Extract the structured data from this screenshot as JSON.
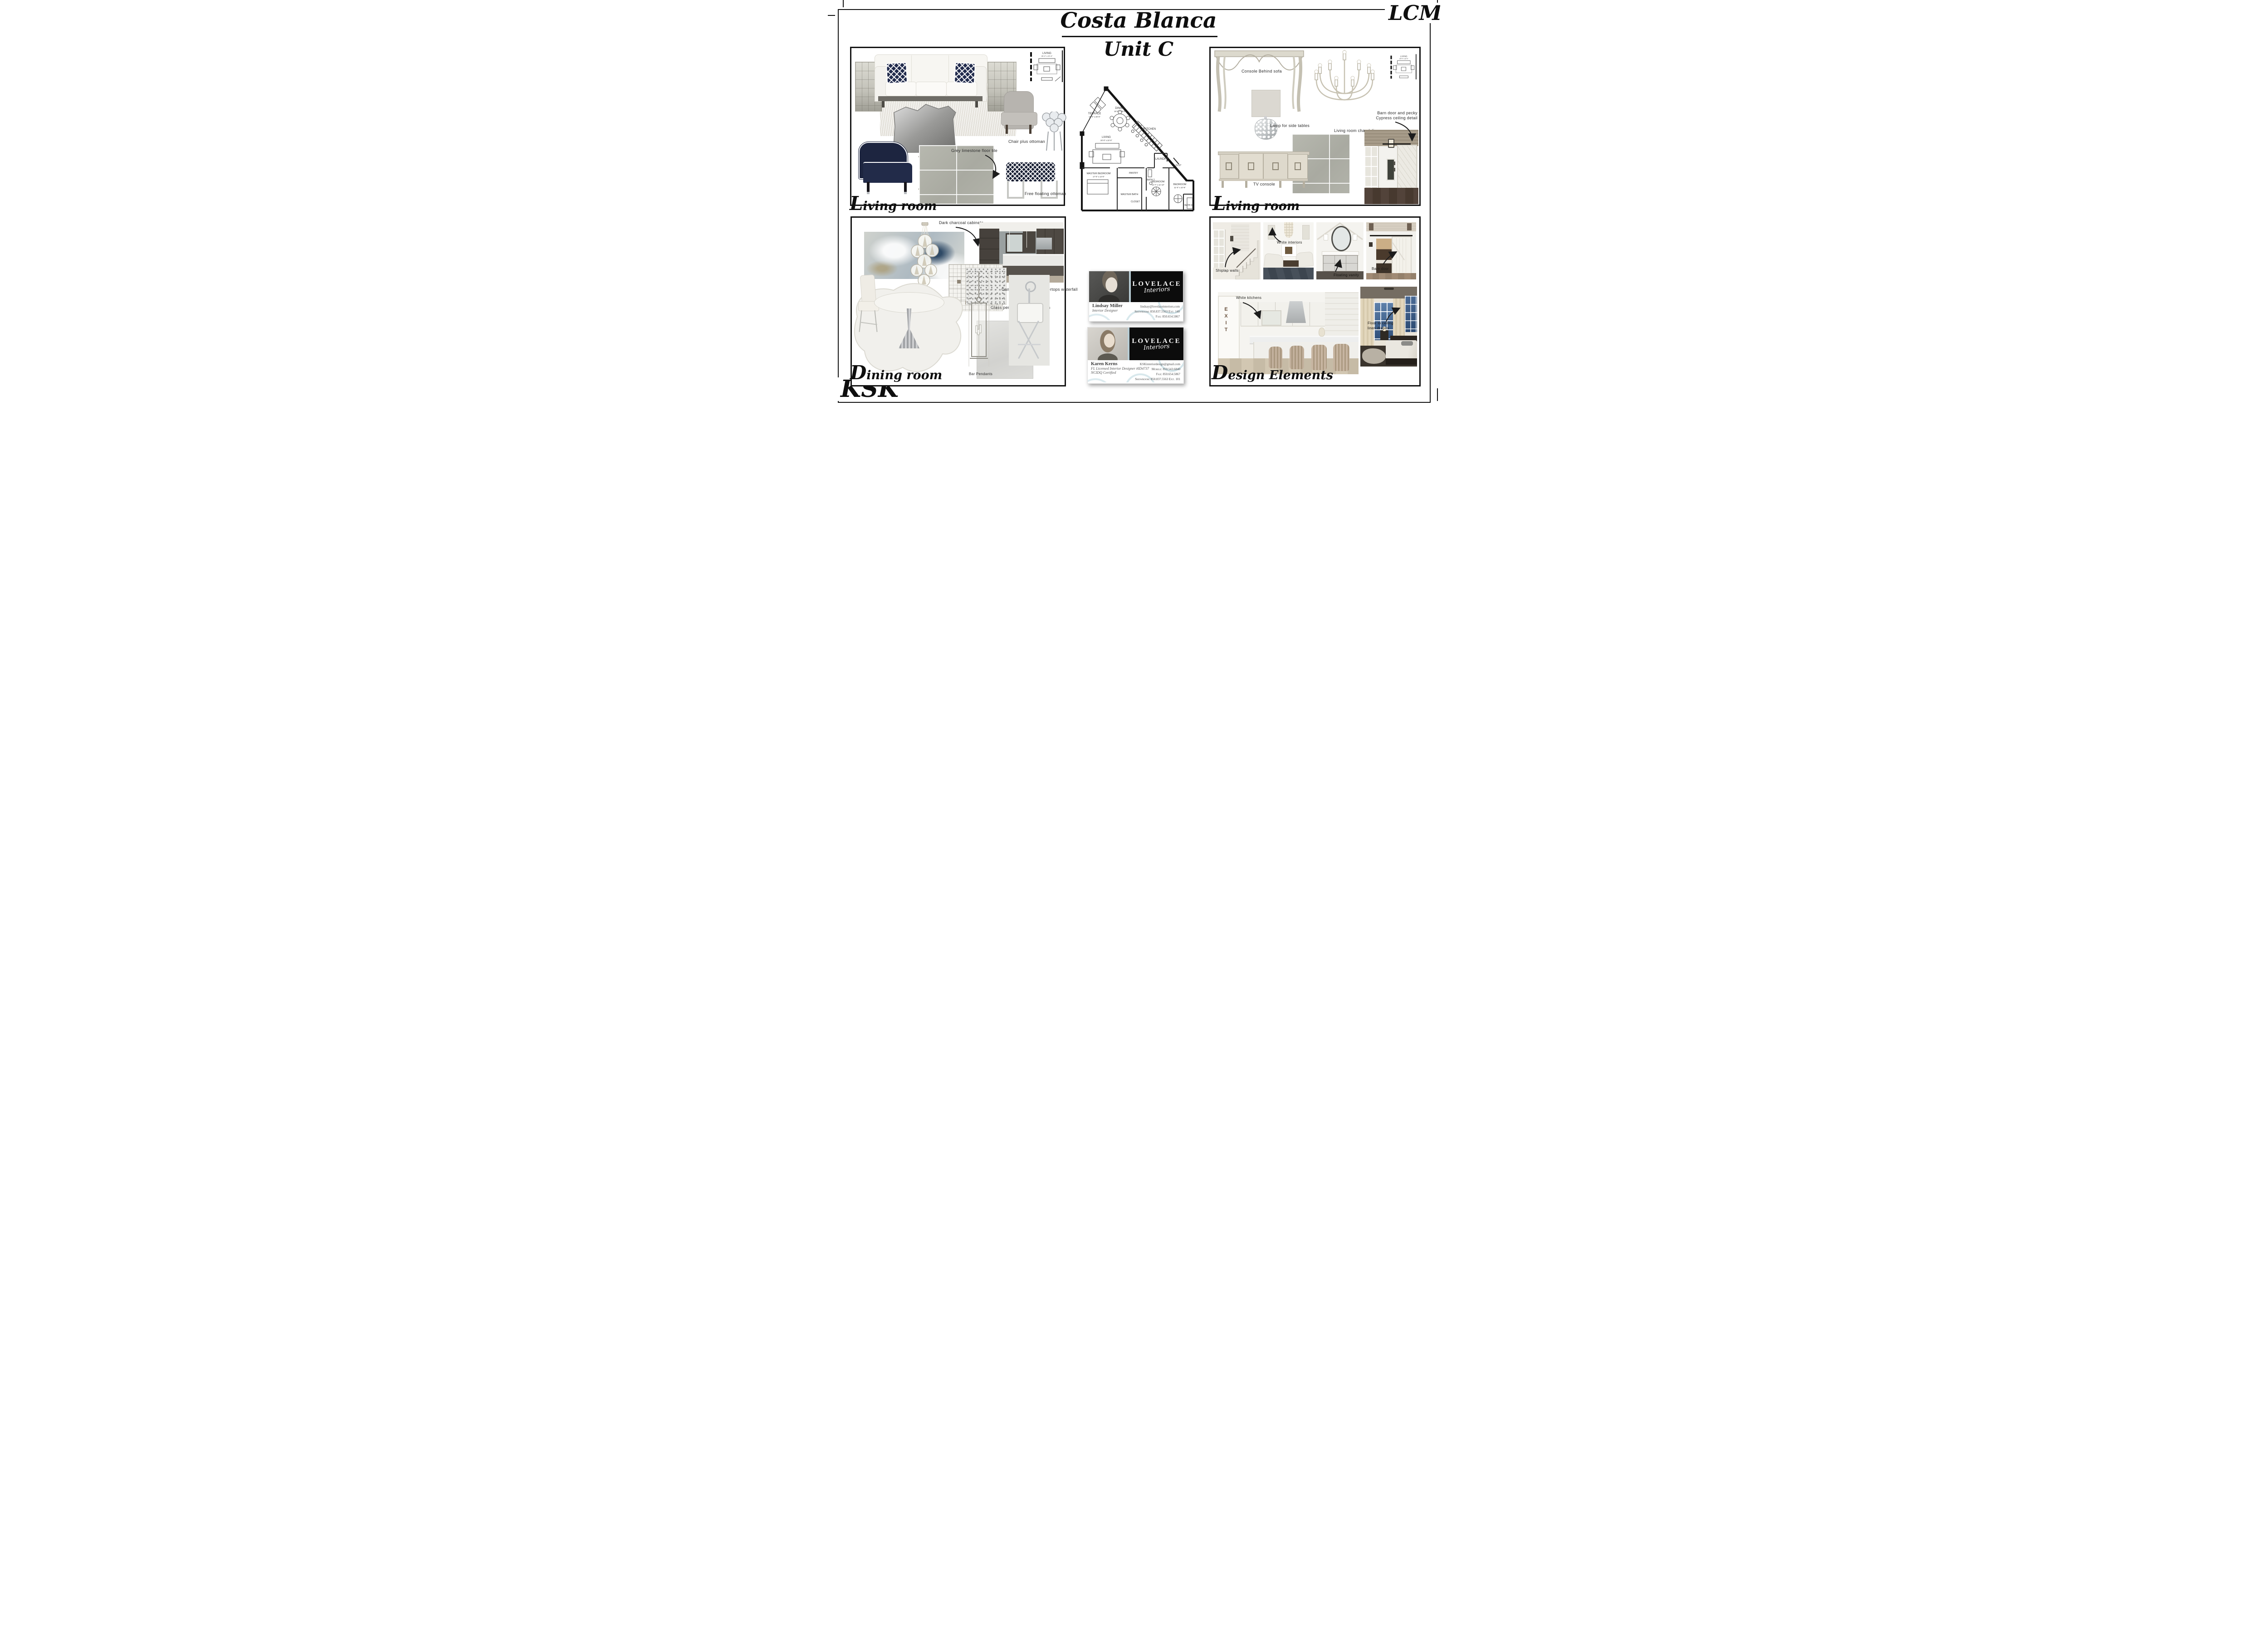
{
  "header": {
    "title": "Costa Blanca",
    "subtitle": "Unit C",
    "monogram_top_right": "LCM",
    "monogram_bottom_left": "KSK"
  },
  "living1": {
    "title": "Living room",
    "chair_label": "Chair plus ottoman",
    "tile_label": "Grey limestone floor tile",
    "ottoman_label": "Free floating ottoman"
  },
  "living2": {
    "title": "Living room",
    "console_label": "Console Behind sofa",
    "lamp_label": "Lamp for side tables",
    "chandelier_label": "Living room chandelier",
    "barn_label_1": "Barn door and pecky",
    "barn_label_2": "Cypress ceiling detail",
    "tv_label": "TV console"
  },
  "dining": {
    "title": "Dining room",
    "cabinets_label": "Dark charcoal cabinets",
    "countertop_label": "Cambria Whitney Countertops waterfall",
    "backsplash_label": "Glass penny round backsplash",
    "pendants_label": "Bar Pendants"
  },
  "design": {
    "title": "Design Elements",
    "shiplap_label": "Shiplap walls",
    "interiors_label": "White interiors",
    "vanity_label": "Floating vanity",
    "barn_door_label": "Barn door",
    "kitchens_label": "White kitchens",
    "exit_sign": "EXIT",
    "drapes_label_1": "Floor to ceiling",
    "drapes_label_2": "linen drapes"
  },
  "floor_plan": {
    "terrace": "TERRACE",
    "terrace_dims": "12'-0\" x 20'-0\"",
    "dining": "DINING",
    "dining_dims": "16'-0\" x 18'-0\"",
    "living": "LIVING",
    "living_dims": "20'-0\" x 22'-0\"",
    "kitchen": "KITCHEN",
    "laundry": "LAUNDRY",
    "clst": "CLST",
    "pantry": "PANTRY",
    "master_bedroom": "MASTER BEDROOM",
    "master_bedroom_dims": "17'-0\" x 14'-0\"",
    "master_bath": "MASTER BATH",
    "closet": "CLOSET",
    "bath2": "BATH 2",
    "bedroom2": "BEDROOM",
    "bedroom2_dims": "14'-7\" x 11'-10\"",
    "bedroom3": "BEDROOM",
    "bedroom3_dims": "11'-0\" x 10'-9\"",
    "bath3": "BATH 3"
  },
  "cards": {
    "brand": "LOVELACE",
    "brand_script": "Interiors",
    "card1": {
      "name": "Lindsay Miller",
      "role": "Interior Designer",
      "email": "lindsay@lovelaceinteriors.com",
      "line2": "Showroom: 850.837.5563 Ext. 140",
      "line3": "Fax: 850.654.5867"
    },
    "card2": {
      "name": "Karen Kerns",
      "role1": "FL Licensed Interior Designer #ID4737",
      "role2": "NCIDQ Certified",
      "email": "KSKinteriordesign@gmail.com",
      "line2": "Mobile: 850.543.6840",
      "line3": "Fax: 850.654.5867",
      "line4": "Showroom: 850.837.5563 Ext. 101"
    }
  }
}
